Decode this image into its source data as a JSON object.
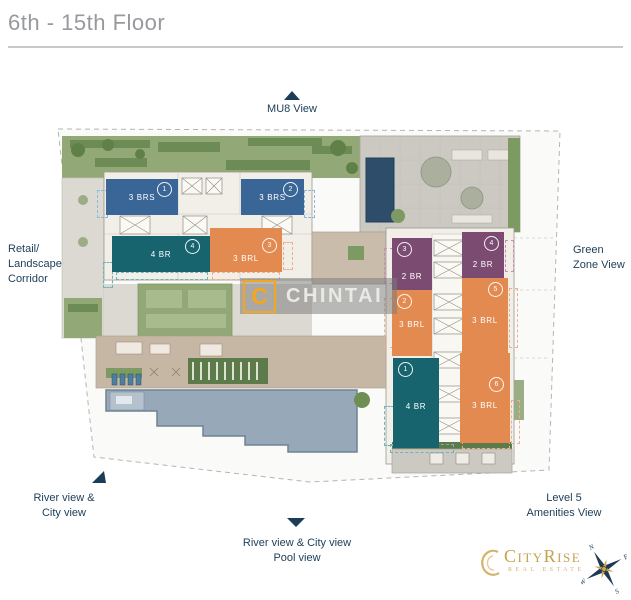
{
  "header": {
    "title": "6th - 15th Floor"
  },
  "plan": {
    "views": {
      "top": "MU8 View",
      "left": [
        "Retail/",
        "Landscape",
        "Corridor"
      ],
      "right": [
        "Green",
        "Zone View"
      ],
      "bottom_left": [
        "River view &",
        "City view"
      ],
      "bottom_right": [
        "Level 5",
        "Amenities View"
      ],
      "bottom_center": [
        "River view & City view",
        "Pool view"
      ]
    },
    "units": {
      "left_wing": [
        {
          "no": "1",
          "type": "3 BRS",
          "color_key": "blue"
        },
        {
          "no": "2",
          "type": "3 BRS",
          "color_key": "blue"
        },
        {
          "no": "4",
          "type": "4 BR",
          "color_key": "teal"
        },
        {
          "no": "3",
          "type": "3 BRL",
          "color_key": "orange"
        }
      ],
      "right_wing": [
        {
          "no": "3",
          "type": "2 BR",
          "color_key": "purple"
        },
        {
          "no": "4",
          "type": "2 BR",
          "color_key": "purple"
        },
        {
          "no": "2",
          "type": "3 BRL",
          "color_key": "orange"
        },
        {
          "no": "5",
          "type": "3 BRL",
          "color_key": "orange"
        },
        {
          "no": "1",
          "type": "4 BR",
          "color_key": "teal"
        },
        {
          "no": "6",
          "type": "3 BRL",
          "color_key": "orange"
        }
      ]
    }
  },
  "watermark": {
    "letter": "C",
    "name": "CHINTAI"
  },
  "brand": {
    "name": "CityRise",
    "subtitle": "Real Estate",
    "compass": {
      "n": "N",
      "e": "E",
      "s": "S",
      "w": "W"
    }
  },
  "colors": {
    "blue": "#3a6597",
    "teal": "#17646f",
    "orange": "#e28a50",
    "purple": "#7b4b72",
    "navy_text": "#1c3d57",
    "title_gray": "#97999c",
    "chintai_orange": "#f3a61e",
    "brand_gold": "#c6a14e"
  }
}
